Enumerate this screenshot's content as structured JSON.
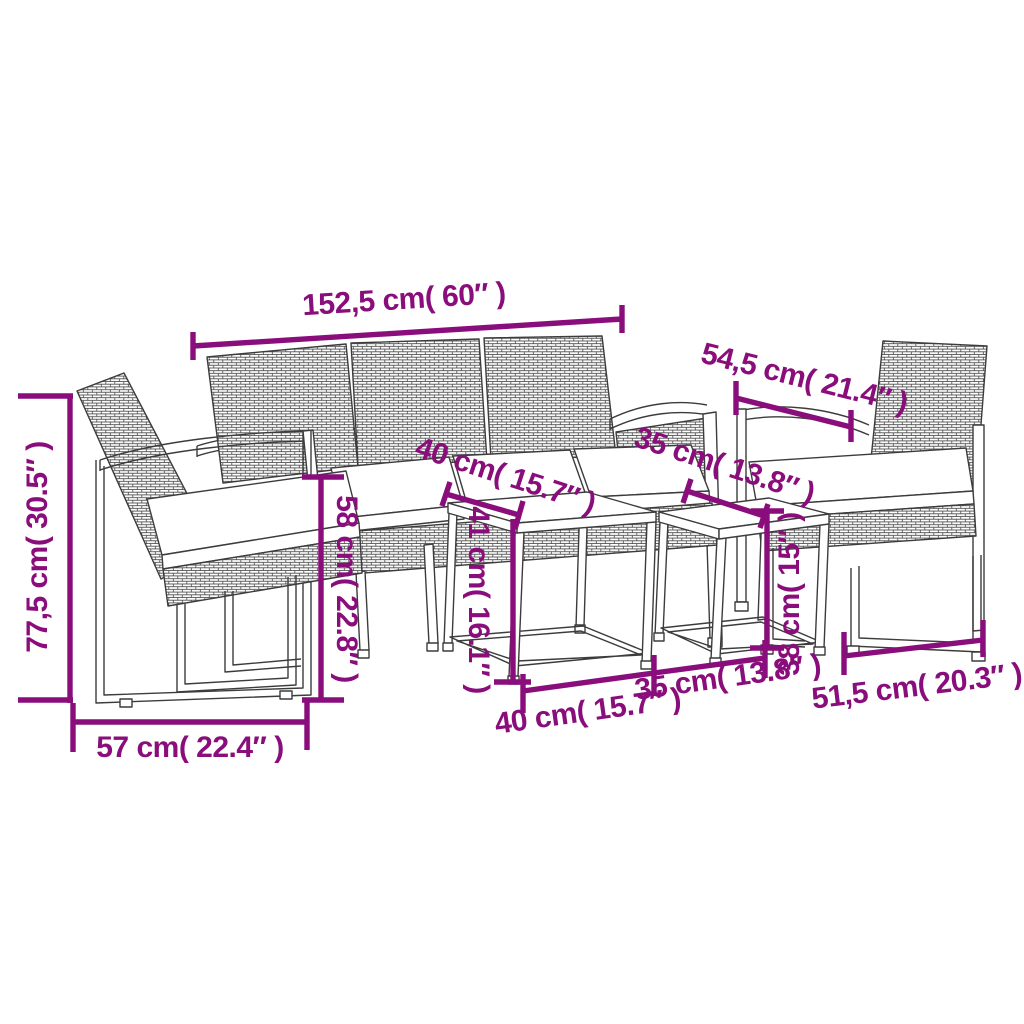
{
  "colors": {
    "dimension_annotation": "#8a0d7c",
    "line_art": "#3c3c3c",
    "background": "#ffffff",
    "cushion_fill": "#ffffff"
  },
  "diagram": {
    "type": "furniture-dimension-diagram",
    "pieces": [
      "left-armchair",
      "three-seat-sofa",
      "large-nesting-table",
      "small-nesting-table",
      "right-armchair"
    ]
  },
  "dims": [
    {
      "name": "sofa-width",
      "label": "152,5 cm( 60″ )"
    },
    {
      "name": "armchair-depth-top",
      "label": "54,5 cm( 21.4″ )"
    },
    {
      "name": "armchair-height",
      "label": "77,5 cm( 30.5″ )"
    },
    {
      "name": "armchair-width-left",
      "label": "57 cm( 22.4″ )"
    },
    {
      "name": "seat-height",
      "label": "58 cm( 22.8″ )"
    },
    {
      "name": "large-table-depth",
      "label": "40 cm( 15.7″ )"
    },
    {
      "name": "large-table-height",
      "label": "41 cm( 16.1″ )"
    },
    {
      "name": "small-table-depth",
      "label": "35 cm( 13.8″ )"
    },
    {
      "name": "small-table-height",
      "label": "38 cm( 15″ )"
    },
    {
      "name": "large-table-width",
      "label": "40 cm( 15.7″ )"
    },
    {
      "name": "small-table-width",
      "label": "35 cm( 13.8″ )"
    },
    {
      "name": "armchair-width-right",
      "label": "51,5 cm( 20.3″ )"
    }
  ]
}
